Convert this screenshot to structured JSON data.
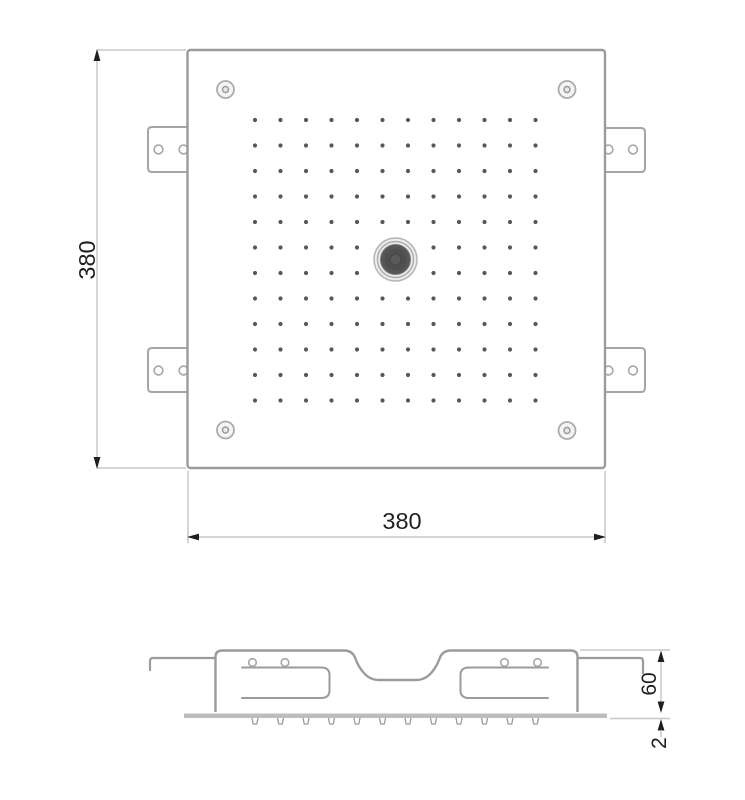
{
  "colors": {
    "background": "#ffffff",
    "object_line": "#9b9b9b",
    "bracket_line": "#a6a6a6",
    "dimension_line": "#c8c8c8",
    "arrow_text": "#1f1f1f",
    "nozzle_dot": "#585858",
    "face_plate": "#bdbdbd",
    "knob_dark": "#4f4f4f"
  },
  "top_view": {
    "width_label": "380",
    "height_label": "380",
    "nozzle_grid": {
      "rows": 12,
      "cols": 12
    },
    "corner_screw_count": 4,
    "mounting_bracket_count": 4
  },
  "side_view": {
    "height_label": "60",
    "plate_thickness_label": "2",
    "nozzle_tick_count": 12
  }
}
